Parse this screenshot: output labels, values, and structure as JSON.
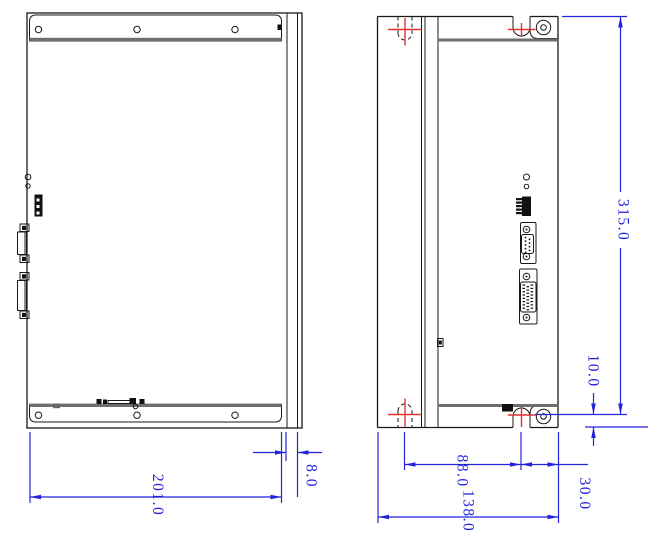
{
  "drawing": {
    "dimensions": {
      "plate_width": "201.0",
      "flange_depth": "8.0",
      "overall_height": "315.0",
      "hole_to_bottom": "10.0",
      "slot_spacing": "88.0",
      "notch_to_edge": "30.0",
      "overall_depth": "138.0"
    },
    "colors": {
      "dimension_lines": "#2323dc",
      "centerlines": "#e03232",
      "outlines": "#1a1a1a"
    }
  }
}
